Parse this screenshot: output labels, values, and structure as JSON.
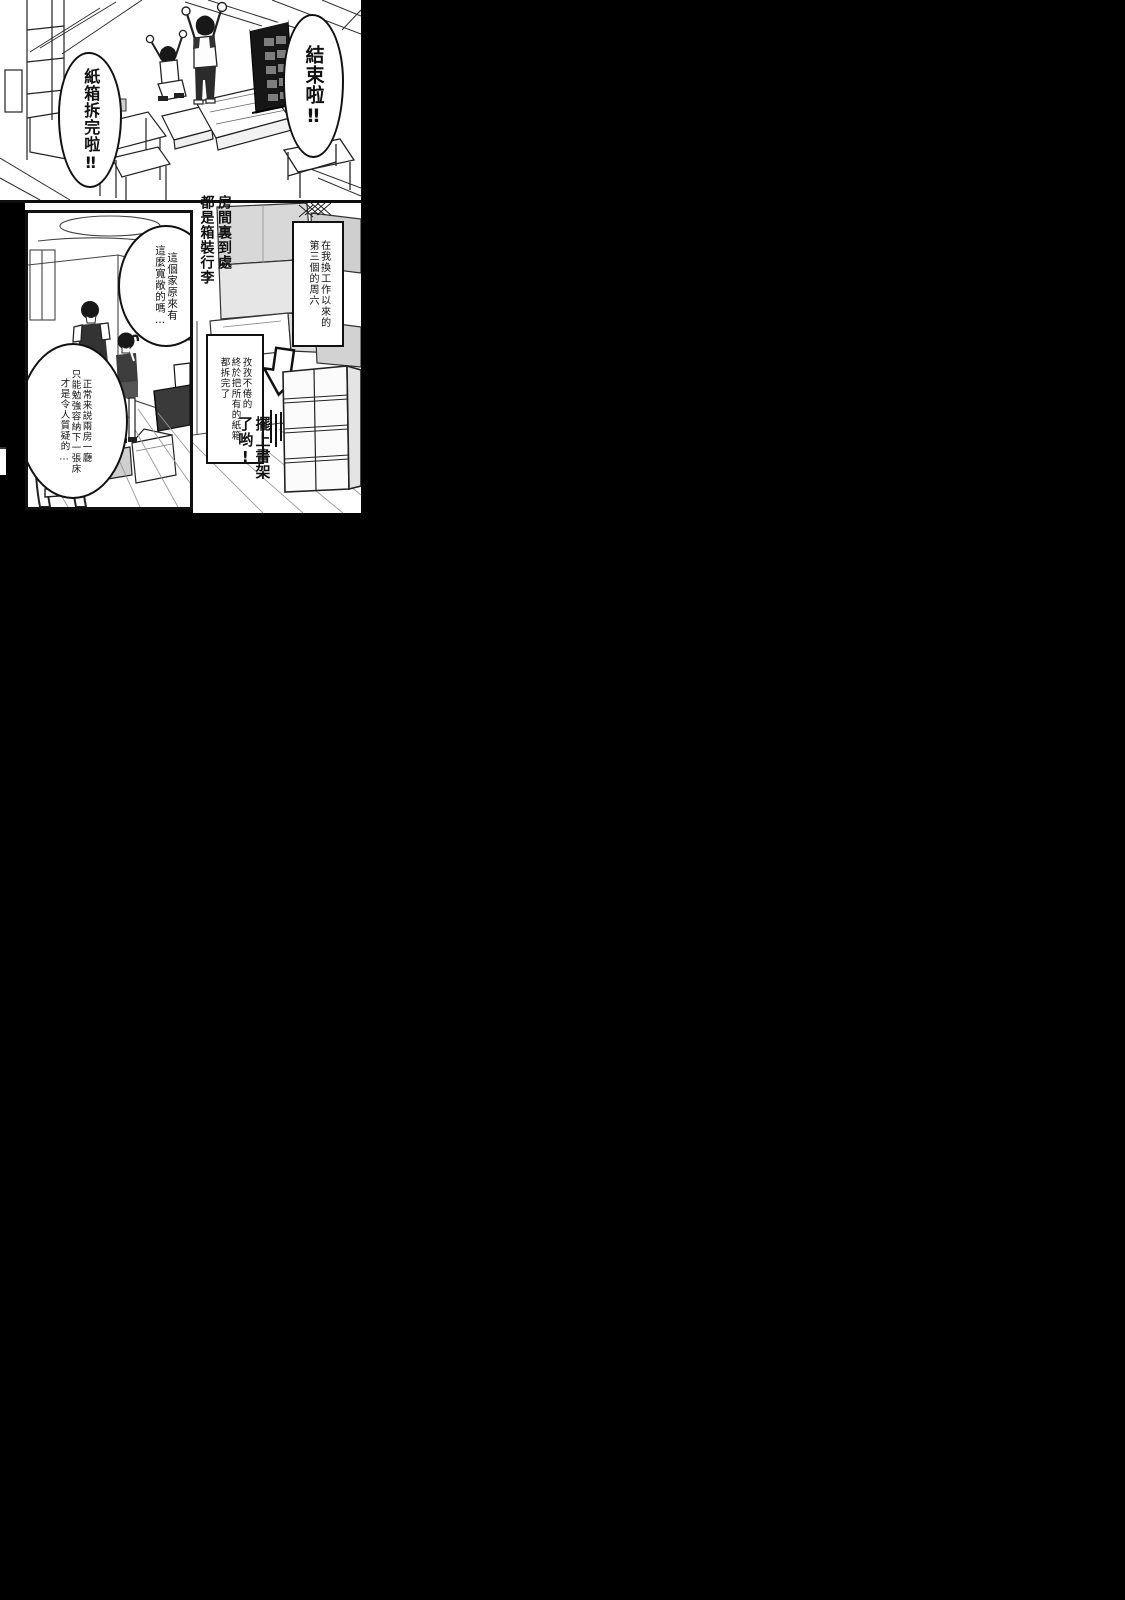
{
  "page": {
    "background": "#000000",
    "paper": "#ffffff",
    "ink": "#111111",
    "tone_gray": "#d8d8d8"
  },
  "celebration_panel": {
    "bubble_finished": "結束啦‼",
    "bubble_boxes_done": "紙箱拆完啦‼"
  },
  "room_panel": {
    "bubble_spacious": "這個家原來有\n這麼寬敞的嗎…",
    "bubble_doubt": "正常来説兩房一廳\n只能勉強容納下一張床\n才是令人質疑的…"
  },
  "unpacking_panel": {
    "narration_title": "房間裏到處\n都是箱裝行李",
    "caption_saturday": "在我換工作以來的\n第三個的周六",
    "caption_unpacked": "孜孜不倦的\n終於把所有的紙箱\n都拆完了",
    "shout_bookshelf": "擺上書架\n了哟!"
  }
}
